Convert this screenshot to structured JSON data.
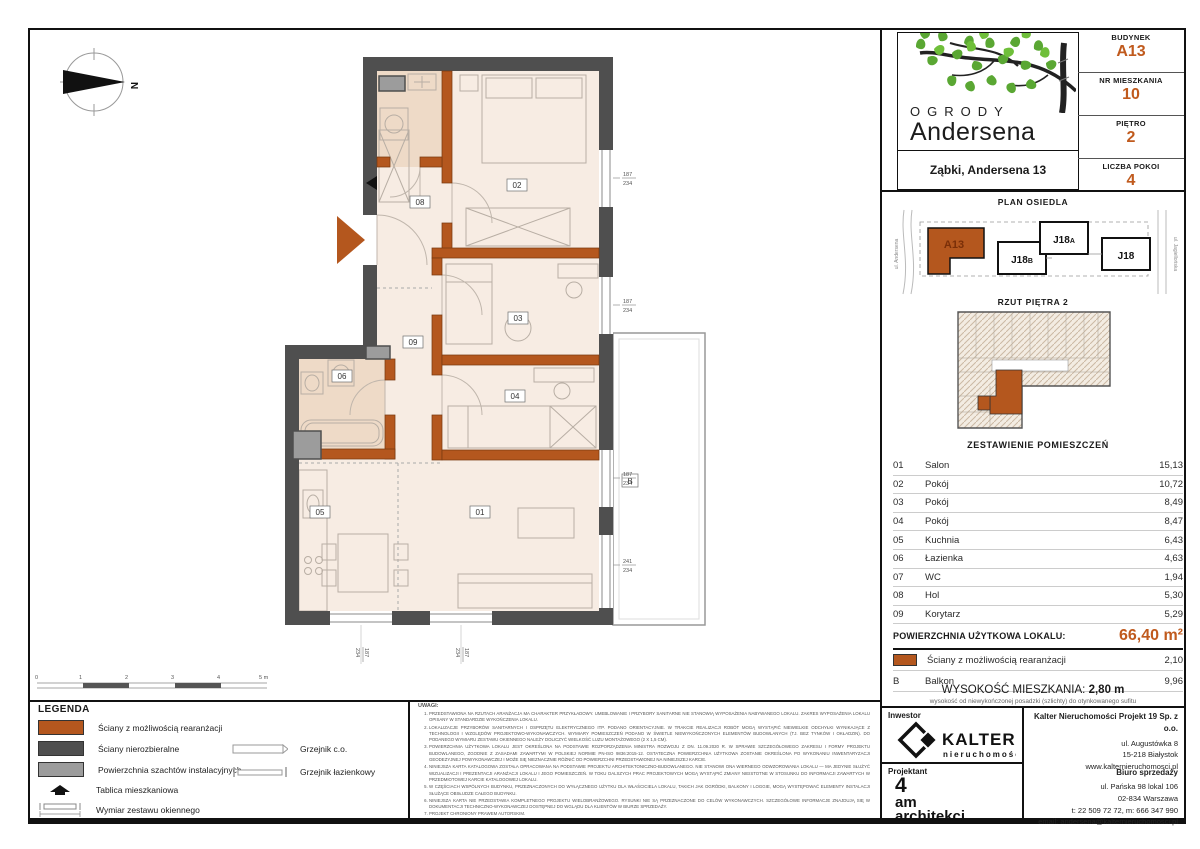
{
  "colors": {
    "accent": "#c05a1d",
    "wall_dark": "#4f4f4f",
    "wall_orange": "#b4571e",
    "shaft": "#9c9c9c",
    "room": "#f7ece3",
    "room_dark": "#eedac7"
  },
  "header": {
    "brand_top": "OGRODY",
    "brand_bottom": "Andersena",
    "address": "Ząbki, Andersena 13",
    "fields": [
      {
        "label": "BUDYNEK",
        "value": "A13"
      },
      {
        "label": "NR MIESZKANIA",
        "value": "10"
      },
      {
        "label": "PIĘTRO",
        "value": "2"
      },
      {
        "label": "LICZBA POKOI",
        "value": "4"
      }
    ]
  },
  "site_plan": {
    "title": "PLAN OSIEDLA",
    "buildings": [
      {
        "main": "A13",
        "sub": ""
      },
      {
        "main": "J18",
        "sub": "B"
      },
      {
        "main": "J18",
        "sub": "A"
      },
      {
        "main": "J18",
        "sub": ""
      }
    ],
    "street_left": "ul. Andersena",
    "street_right": "ul. Jagiellońska"
  },
  "floor_overview": {
    "title": "RZUT PIĘTRA 2"
  },
  "rooms_table": {
    "title": "ZESTAWIENIE POMIESZCZEŃ",
    "rows": [
      {
        "no": "01",
        "name": "Salon",
        "area": "15,13"
      },
      {
        "no": "02",
        "name": "Pokój",
        "area": "10,72"
      },
      {
        "no": "03",
        "name": "Pokój",
        "area": "8,49"
      },
      {
        "no": "04",
        "name": "Pokój",
        "area": "8,47"
      },
      {
        "no": "05",
        "name": "Kuchnia",
        "area": "6,43"
      },
      {
        "no": "06",
        "name": "Łazienka",
        "area": "4,63"
      },
      {
        "no": "07",
        "name": "WC",
        "area": "1,94"
      },
      {
        "no": "08",
        "name": "Hol",
        "area": "5,30"
      },
      {
        "no": "09",
        "name": "Korytarz",
        "area": "5,29"
      }
    ],
    "total_label": "POWIERZCHNIA UŻYTKOWA LOKALU:",
    "total_value": "66,40 m²",
    "walls_row": {
      "name": "Ściany z możliwością rearanżacji",
      "area": "2,10"
    },
    "balcony_row": {
      "no": "B",
      "name": "Balkon",
      "area": "9,96"
    }
  },
  "ceiling": {
    "label": "WYSOKOŚĆ MIESZKANIA:",
    "value": "2,80 m",
    "note": "wysokość od niewykończonej posadzki (szlichty) do otynkowanego sufitu"
  },
  "footer": {
    "investor_label": "Inwestor",
    "investor_logo_name": "KALTER",
    "investor_logo_sub": "nieruchomości",
    "company_name": "Kalter Nieruchomości Projekt 19 Sp. z o.o.",
    "company_lines": [
      "ul. Augustówka 8",
      "15-218 Białystok",
      "www.kalternieruchomosci.pl"
    ],
    "designer_label": "Projektant",
    "designer_lines": [
      "4",
      "am",
      "architekci"
    ],
    "sales_title": "Biuro sprzedaży",
    "sales_lines": [
      "ul. Pańska 98 lokal 106",
      "02-834 Warszawa",
      "t: 22 509 72 72, m: 666 347 990",
      "email: andersena@kalternieruchomosci.pl"
    ]
  },
  "legend": {
    "title": "LEGENDA",
    "items": [
      "Ściany z możliwością rearanżacji",
      "Ściany nierozbieralne",
      "Powierzchnia szachtów instalacyjnych",
      "Tablica mieszkaniowa",
      "Wymiar zestawu okiennego"
    ],
    "items2": [
      "Grzejnik c.o.",
      "Grzejnik łazienkowy"
    ]
  },
  "scale_bar": {
    "ticks": [
      "0",
      "1",
      "2",
      "3",
      "4",
      "5 m"
    ]
  },
  "notes": {
    "title": "UWAGI:",
    "items": [
      "PRZEDSTAWIONA NA RZUTACH ARANŻACJA MA CHARAKTER PRZYKŁADOWY. UMEBLOWANIE I PRZYBORY SANITARNE NIE STANOWIĄ WYPOSAŻENIA NABYWANEGO LOKALU. ZAKRES WYPOSAŻENIA LOKALU OPISANY W STANDARDZIE WYKOŃCZENIA LOKALU.",
      "LOKALIZACJE PRZYBORÓW SANITARNYCH I OSPRZĘTU ELEKTRYCZNEGO ITP. PODANO ORIENTACYJNIE. W TRAKCIE REALIZACJI ROBÓT MOGĄ WYSTĄPIĆ NIEWIELKIE ODCHYŁKI WYNIKAJĄCE Z TECHNOLOGII I WZGLĘDÓW PROJEKTOWO-WYKONAWCZYCH. WYMIARY POMIESZCZEŃ PODANO W ŚWIETLE NIEWYKOŃCZONYCH ELEMENTÓW BUDOWLANYCH (TJ. BEZ TYNKÓW I OKŁADZIN). DO PODANEGO WYMIARU ZESTAWU OKIENNEGO NALEŻY DOLICZYĆ WIELKOŚĆ LUZU MONTAŻOWEGO (2 X 1,5 CM).",
      "POWIERZCHNIA UŻYTKOWA LOKALU JEST OKREŚLONA NA PODSTAWIE ROZPORZĄDZENIA MINISTRA ROZWOJU Z DN. 11.09.2020 R. W SPRAWIE SZCZEGÓŁOWEGO ZAKRESU I FORMY PROJEKTU BUDOWLANEGO, ZGODNIE Z ZASADAMI ZAWARTYMI W POLSKIEJ NORMIE PN-ISO 9836:2015-12. OSTATECZNA POWIERZCHNIA UŻYTKOWA ZOSTANIE OKREŚLONA PO WYKONANIU INWENTARYZACJI GEODEZYJNEJ POWYKONAWCZEJ I MOŻE SIĘ NIEZNACZNIE RÓŻNIĆ OD POWIERZCHNI PRZEDSTAWIONEJ NA NINIEJSZEJ KARCIE.",
      "NINIEJSZA KARTA KATALOGOWA ZOSTAŁA OPRACOWANA NA PODSTAWIE PROJEKTU ARCHITEKTONICZNO-BUDOWLANEGO. NIE STANOWI ONA WIERNEGO ODWZOROWANIA LOKALU — MA JEDYNIE SŁUŻYĆ WIZUALIZACJI I PREZENTACJI ARANŻACJI LOKALU I JEGO POMIESZCZEŃ. W TOKU DALSZYCH PRAC PROJEKTOWYCH MOGĄ WYSTĄPIĆ ZMIANY NIEISTOTNE W STOSUNKU DO INFORMACJI ZAWARTYCH W PRZEDMIOTOWEJ KARCIE KATALOGOWEJ LOKALU.",
      "W CZĘŚCIACH WSPÓLNYCH BUDYNKU, PRZEZNACZONYCH DO WYŁĄCZNEGO UŻYTKU DLA WŁAŚCICIELA LOKALU, TAKICH JAK OGRÓDKI, BALKONY I LOGGIE, MOGĄ WYSTĘPOWAĆ ELEMENTY INSTALACJI SŁUŻĄCE OBSŁUDZE CAŁEGO BUDYNKU.",
      "NINIEJSZA KARTA NIE PRZEDSTAWIA KOMPLETNEGO PROJEKTU WIELOBRANŻOWEGO. RYSUNKI NIE SĄ PRZEZNACZONE DO CELÓW WYKONAWCZYCH. SZCZEGÓŁOWE INFORMACJE ZNAJDUJĄ SIĘ W DOKUMENTACJI TECHNICZNO-WYKONAWCZEJ DOSTĘPNEJ DO WGLĄDU DLA KLIENTÓW W BIURZE SPRZEDAŻY.",
      "PROJEKT CHRONIONY PRAWEM AUTORSKIM."
    ]
  },
  "plan": {
    "north": "N",
    "balcony": "B",
    "room_labels": {
      "r01": "01",
      "r02": "02",
      "r03": "03",
      "r04": "04",
      "r05": "05",
      "r06": "06",
      "r08": "08",
      "r09": "09"
    },
    "window_labels": [
      {
        "w": "187",
        "h": "234"
      },
      {
        "w": "187",
        "h": "234"
      },
      {
        "w": "187",
        "h": "234"
      },
      {
        "w": "241",
        "h": "234"
      },
      {
        "w": "187",
        "h": "234"
      },
      {
        "w": "187",
        "h": "234"
      }
    ]
  }
}
